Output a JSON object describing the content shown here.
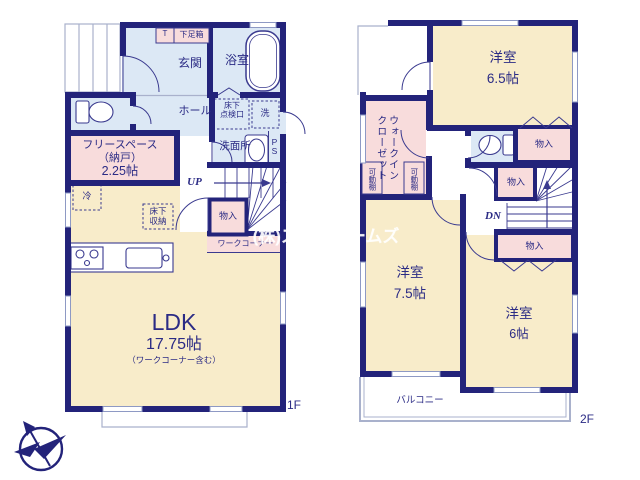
{
  "meta": {
    "floor1_label": "1F",
    "floor2_label": "2F",
    "watermark": "(株)スターホームズ",
    "colors": {
      "wall": "#23237a",
      "room_cream": "#f8ecca",
      "room_blue": "#dce8f5",
      "room_pink": "#f8dcdc",
      "window": "#8e99c4"
    }
  },
  "floor1": {
    "tall_cabinet": "T",
    "shoe_box": "下足箱",
    "entrance": "玄関",
    "bathroom": "浴室",
    "hall": "ホール",
    "underfloor_access": "床下\n点検口",
    "laundry": "洗",
    "washroom": "洗面所",
    "pipe_space": "PS",
    "free_space": "フリースペース\n（納戸）",
    "free_space_size": "2.25帖",
    "refrigerator": "冷",
    "stairs_up": "UP",
    "closet": "物入",
    "work_corner": "ワークコーナー",
    "underfloor_storage": "床下\n収納",
    "ldk": "LDK",
    "ldk_size": "17.75帖",
    "ldk_note": "（ワークコーナー含む）"
  },
  "floor2": {
    "bedroom1": "洋室",
    "bedroom1_size": "6.5帖",
    "walk_in_closet": "ウォークイン\nクローゼット",
    "movable_shelf_left": "可動棚",
    "movable_shelf_right": "可動棚",
    "closet_top": "物入",
    "closet_mid": "物入",
    "closet_bottom": "物入",
    "stairs_down": "DN",
    "bedroom2": "洋室",
    "bedroom2_size": "7.5帖",
    "bedroom3": "洋室",
    "bedroom3_size": "6帖",
    "balcony": "バルコニー"
  }
}
